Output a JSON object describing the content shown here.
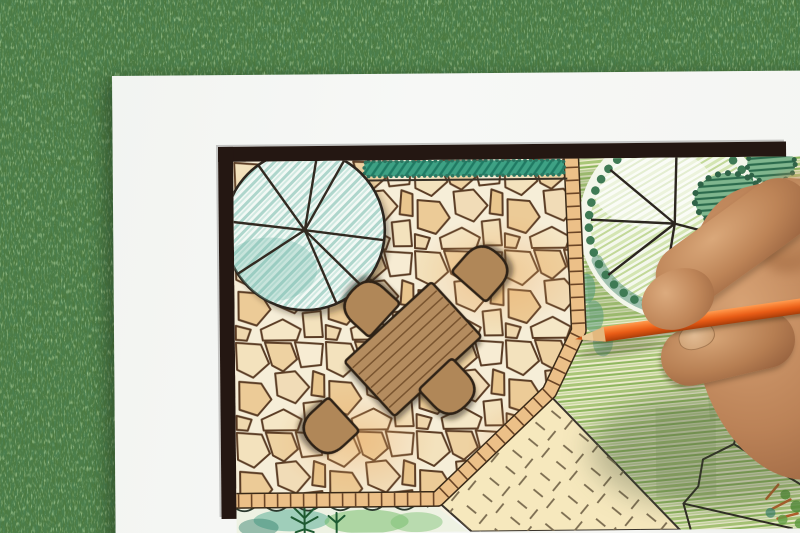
{
  "scene": {
    "type": "photograph",
    "description": "Hand drawing a garden landscape plan with an orange colored pencil on white paper lying on grass",
    "background": {
      "label": "grass lawn background",
      "color": "#4c7a40"
    },
    "paper": {
      "label": "white paper sheet",
      "color": "#f5f6f4"
    },
    "plan": {
      "label": "hand-drawn garden plan with dark frame border",
      "frame_color": "#241712",
      "elements": {
        "patio": {
          "label": "flagstone patio",
          "stone_color": "#f0d9ae",
          "joint_color": "#5a3c24"
        },
        "tile_edging": {
          "label": "tile border edging",
          "tile_color": "#ecc088",
          "joint_color": "#6b4526"
        },
        "hedge": {
          "label": "teal hedge strip along top",
          "color": "#3ea184"
        },
        "shade_tree_left": {
          "label": "round shade tree with teal hatching and radial branches",
          "canopy_color": "#bfe0d9",
          "branch_color": "#322a21"
        },
        "shade_tree_right": {
          "label": "round shade tree with scalloped canopy over lawn",
          "scallop_color": "#3f7a55"
        },
        "bush": {
          "label": "dark hatched shrub",
          "hatch_color": "#2c6b4d"
        },
        "lawn": {
          "label": "green crayon lawn",
          "color": "#9dbf6e"
        },
        "paved_path": {
          "label": "pale paved area with joint tick marks",
          "color": "#f6e8bd",
          "mark_color": "#7a6b4f"
        },
        "planting_bed": {
          "label": "watercolor planting bed with conifer sprigs",
          "color": "#56a88e"
        },
        "bed_outline": {
          "label": "black bed boundary polyline on lawn",
          "color": "#2e2a22"
        },
        "corner_shrub": {
          "label": "small colorful shrub in lower right corner",
          "branch_color": "#b4602a"
        },
        "table": {
          "label": "rectangular wooden plank table",
          "color": "#b48c5f",
          "plank_lines": 7
        },
        "chairs": {
          "label": "rounded patio chairs",
          "count": 4,
          "color": "#b08759"
        }
      }
    },
    "pencil": {
      "label": "orange colored pencil",
      "body_color": "#e85c16",
      "wood_color": "#eccb97",
      "lead_color": "#cf5a1a"
    },
    "hand": {
      "label": "hand holding the pencil",
      "skin_color": "#bb8257"
    }
  }
}
